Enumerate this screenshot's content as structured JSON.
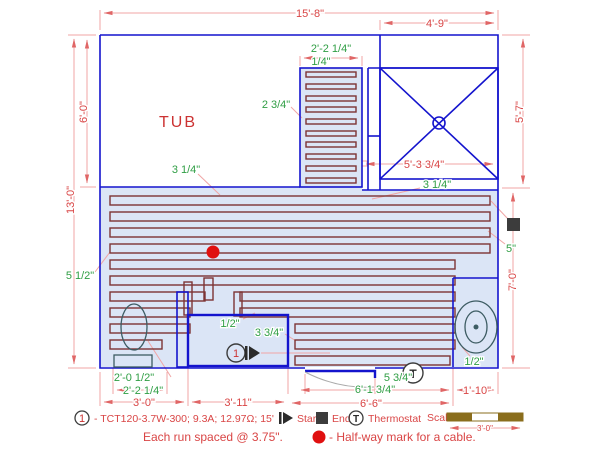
{
  "colors": {
    "wall": "#1414cd",
    "heated_area_fill": "#dbe5f6",
    "cable": "#7d3434",
    "dimension_text": "#d94545",
    "dimension_line": "#f0a5a5",
    "detail_text_green": "#2f9e44",
    "fixture_outline": "#3d5c63",
    "marker_dark": "#3c3c3c",
    "halfway_dot": "#e01010",
    "scale_bar": "#8a6d1c"
  },
  "room": {
    "tub_label": "TUB"
  },
  "dimensions": {
    "overall_width": "15'-8\"",
    "shower_width": "4'-9\"",
    "overall_height": "13'-0\"",
    "tub_depth": "6'-0\"",
    "shower_side": "5'-7\"",
    "right_depth": "7'-0\"",
    "shower_drain": "5'-3 3/4\"",
    "toilet_bay": "3'-0\"",
    "entry_width": "3'-11\"",
    "bottom_span": "6'-6\"",
    "vanity_width": "1'-10\""
  },
  "offsets": {
    "coil_strip_width": "2'-2 1/4\"",
    "coil_strip_gap": "1/4\"",
    "coil_top_gap": "2 3/4\"",
    "tub_edge_gap": "3 1/4\"",
    "shower_edge_gap": "3 1/4\"",
    "right_end_gap": "5\"",
    "left_edge_gap": "5 1/2\"",
    "entry_gap": "1/2\"",
    "entry_end_gap": "3 3/4\"",
    "toilet_side": "2'-0 1/2\"",
    "toilet_center": "2'-2 1/4\"",
    "door_gap": "5 3/4\"",
    "door_span": "6'-1 3/4\"",
    "vanity_gap": "1/2\""
  },
  "markers": {
    "start_circuit_number": "1",
    "thermostat_letter": "T"
  },
  "legend": {
    "circuit_number": "1",
    "circuit_spec": "- TCT120-3.7W-300; 9.3A; 12.97Ω; 15'",
    "start_label": "Start",
    "end_label": "End",
    "thermostat_letter": "T",
    "thermostat_label": "Thermostat",
    "scale_label": "Scale",
    "scale_length": "3'-0\"",
    "note_spacing": "Each run spaced @ 3.75\".",
    "note_halfway": "- Half-way mark for a cable."
  }
}
